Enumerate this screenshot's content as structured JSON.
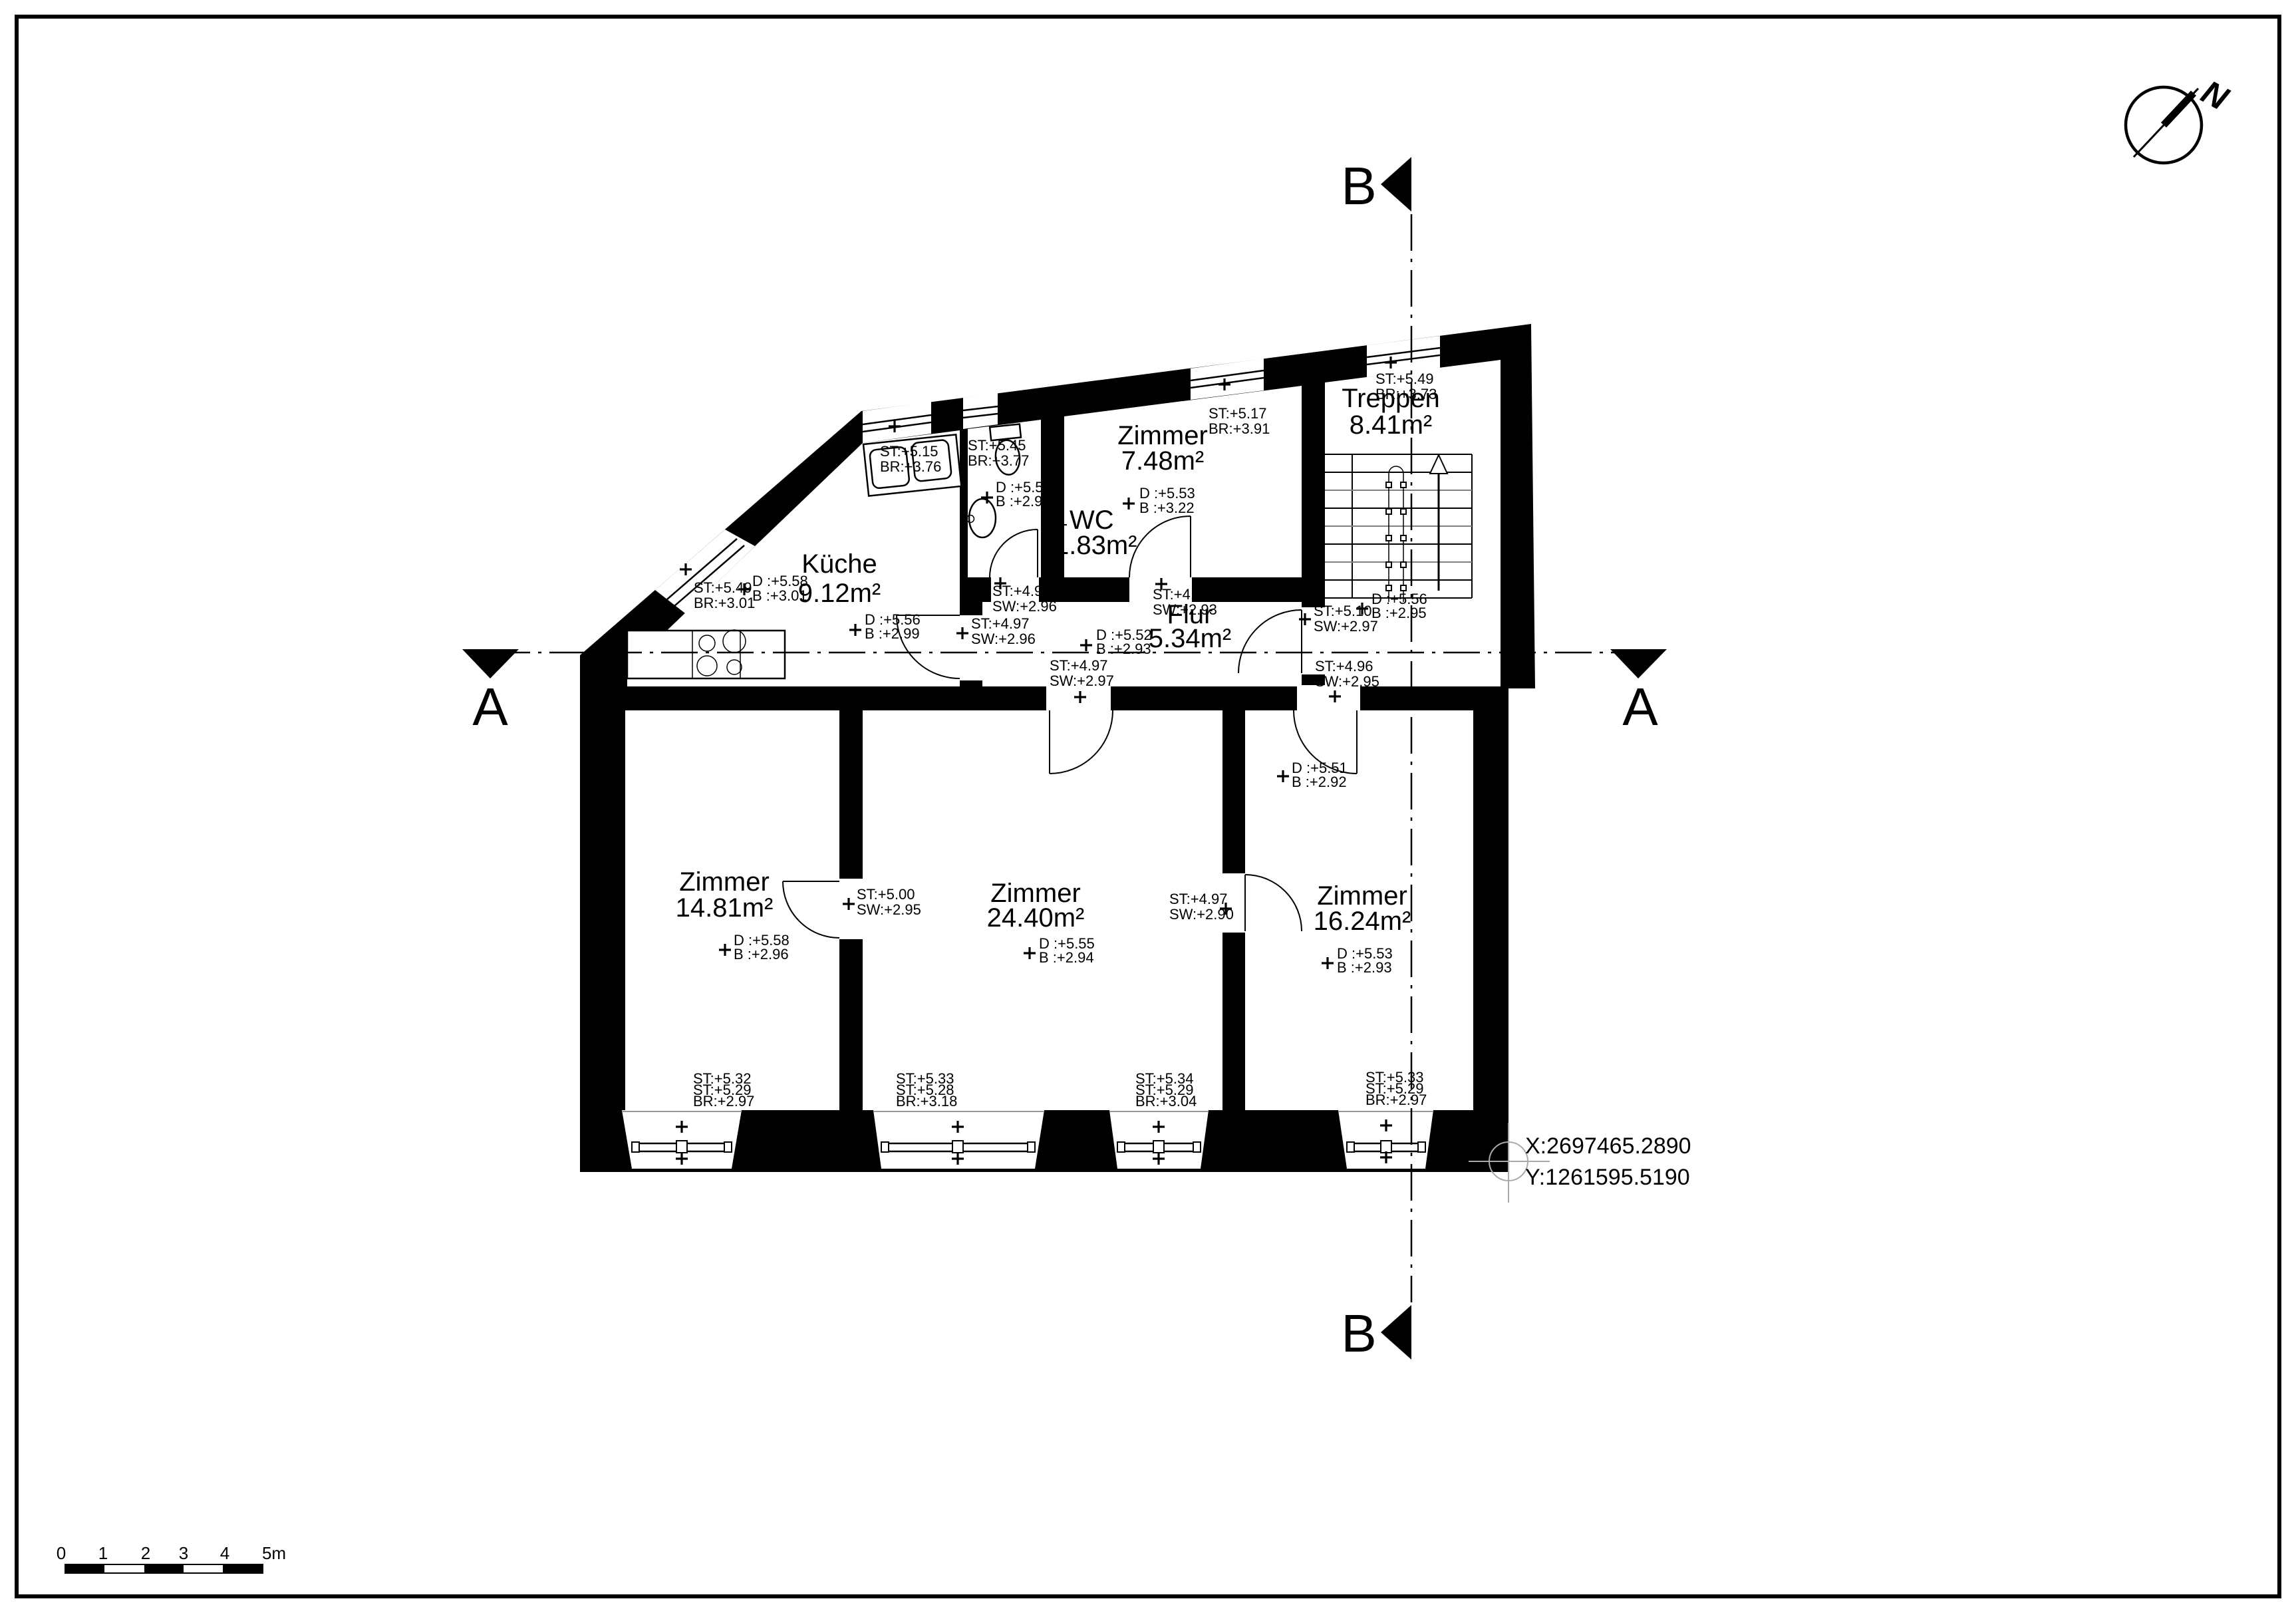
{
  "north": {
    "label": "N"
  },
  "sections": {
    "a": "A",
    "b": "B"
  },
  "survey": {
    "x": "X:2697465.2890",
    "y": "Y:1261595.5190"
  },
  "scalebar": {
    "ticks": [
      "0",
      "1",
      "2",
      "3",
      "4",
      "5m"
    ]
  },
  "rooms": {
    "kueche": {
      "name": "Küche",
      "area": "9.12m²"
    },
    "wc": {
      "name": "WC",
      "area": "1.83m²"
    },
    "z748": {
      "name": "Zimmer",
      "area": "7.48m²"
    },
    "treppen": {
      "name": "Treppen",
      "area": "8.41m²"
    },
    "flur": {
      "name": "Flur",
      "area": "5.34m²"
    },
    "z1481": {
      "name": "Zimmer",
      "area": "14.81m²"
    },
    "z2440": {
      "name": "Zimmer",
      "area": "24.40m²"
    },
    "z1624": {
      "name": "Zimmer",
      "area": "16.24m²"
    }
  },
  "ann": {
    "nw_window": [
      "ST:+5.49",
      "BR:+3.01"
    ],
    "kueche_left_d": [
      "D :+5.58",
      "B :+3.01"
    ],
    "sink_window": [
      "ST:+5.15",
      "BR:+3.76"
    ],
    "wc_window": [
      "ST:+5.45",
      "BR:+3.77"
    ],
    "wc_basin_d": [
      "D :+5.55",
      "B :+2.96"
    ],
    "z748_d": [
      "D :+5.53",
      "B :+3.22"
    ],
    "z748_window": [
      "ST:+5.17",
      "BR:+3.91"
    ],
    "treppen_window": [
      "ST:+5.49",
      "BR:+3.73"
    ],
    "kueche_d": [
      "D :+5.56",
      "B :+2.99"
    ],
    "kueche_st": [
      "ST:+4.96",
      "SW:+2.96"
    ],
    "kueche_st2": [
      "ST:+4.97",
      "SW:+2.96"
    ],
    "flur_st": [
      "ST:+4.96",
      "SW:+2.93"
    ],
    "flur_d": [
      "D :+5.52",
      "B :+2.93"
    ],
    "hall_st_left": [
      "ST:+4.97",
      "SW:+2.97"
    ],
    "hall_st_right": [
      "ST:+4.96",
      "SW:+2.95"
    ],
    "flur_st510": [
      "ST:+5.10",
      "SW:+2.97"
    ],
    "flur_d556": [
      "D :+5.56",
      "B :+2.95"
    ],
    "z1624_d551": [
      "D :+5.51",
      "B :+2.92"
    ],
    "z1481_st": [
      "ST:+5.00",
      "SW:+2.95"
    ],
    "z1481_d": [
      "D :+5.58",
      "B :+2.96"
    ],
    "z2440_d": [
      "D :+5.55",
      "B :+2.94"
    ],
    "z2440_st": [
      "ST:+4.97",
      "SW:+2.90"
    ],
    "z1624_d553": [
      "D :+5.53",
      "B :+2.93"
    ],
    "w1": [
      "ST:+5.32",
      "ST:+5.29",
      "BR:+2.97"
    ],
    "w2": [
      "ST:+5.33",
      "ST:+5.28",
      "BR:+3.18"
    ],
    "w3": [
      "ST:+5.34",
      "ST:+5.29",
      "BR:+3.04"
    ],
    "w4": [
      "ST:+5.33",
      "ST:+5.29",
      "BR:+2.97"
    ]
  }
}
